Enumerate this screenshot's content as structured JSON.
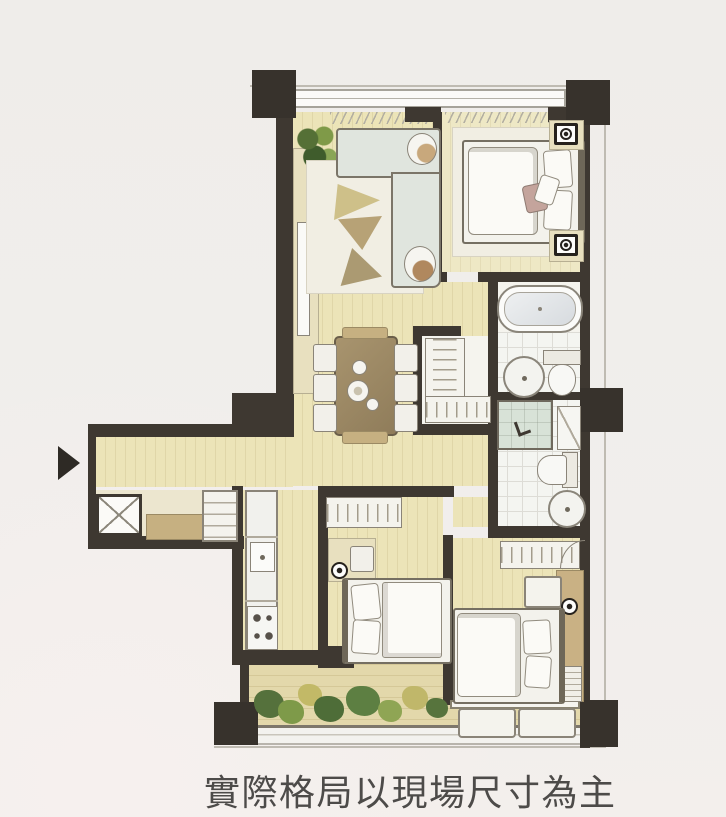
{
  "caption": {
    "text": "實際格局以現場尺寸為主"
  },
  "palette": {
    "background": "#f0edea",
    "wall": "#3e3831",
    "floor_wood": "#ece4b8",
    "balcony_floor": "#e3d8ab",
    "furniture_outline": "#8a8478",
    "sofa": "#e0e5de",
    "wood_accent": "#c6b081",
    "dining_table": "#9f8c68",
    "shower_glass": "#d8e2d7",
    "plant_dark": "#55713c",
    "plant_light": "#c2b967",
    "caption_color": "#4d4b49"
  },
  "icons": {
    "entry_arrow": "solid right-pointing triangle",
    "lamp": "circle with center dot",
    "utility_shaft": "box with X cross"
  }
}
